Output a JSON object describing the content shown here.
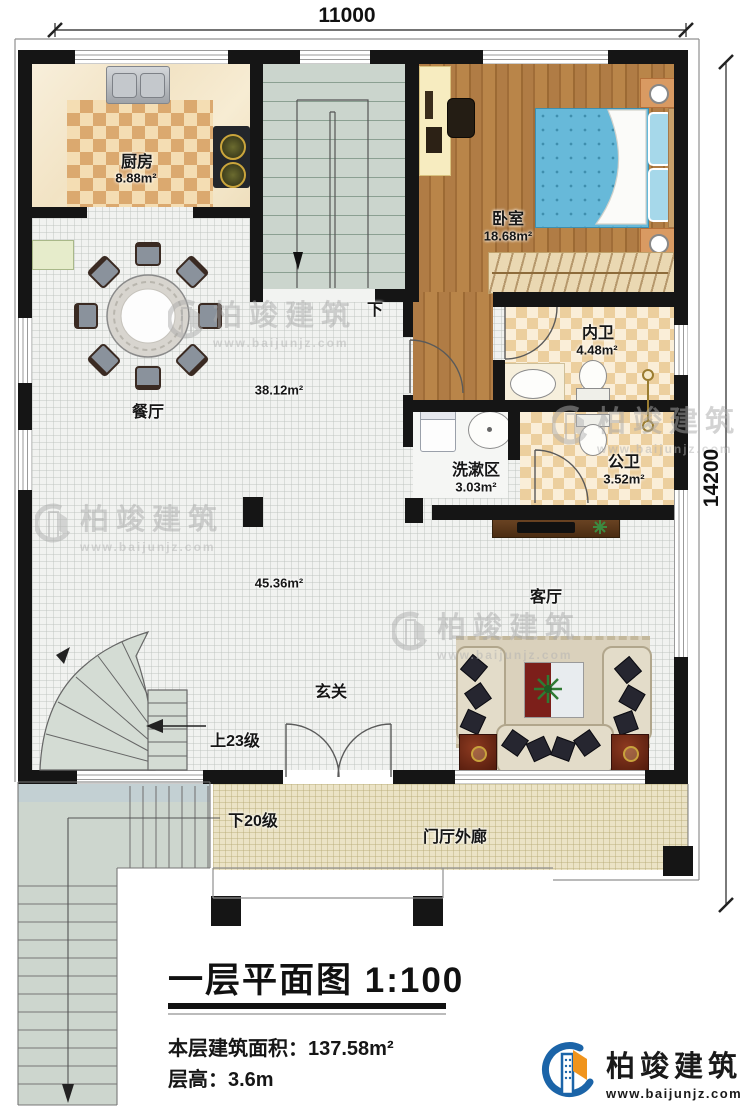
{
  "dimensions": {
    "top": "11000",
    "right": "14200"
  },
  "rooms": {
    "kitchen": {
      "name": "厨房",
      "area": "8.88m²"
    },
    "bedroom": {
      "name": "卧室",
      "area": "18.68m²"
    },
    "inner_bath": {
      "name": "内卫",
      "area": "4.48m²"
    },
    "public_bath": {
      "name": "公卫",
      "area": "3.52m²"
    },
    "wash_area": {
      "name": "洗漱区",
      "area": "3.03m²"
    },
    "dining": {
      "name": "餐厅",
      "area": "38.12m²"
    },
    "living": {
      "name": "客厅",
      "area": "45.36m²"
    },
    "foyer": {
      "name": "玄关"
    },
    "porch": {
      "name": "门厅外廊"
    }
  },
  "stairs": {
    "main_down": "下",
    "up_steps": "上23级",
    "down_steps": "下20级"
  },
  "title_block": {
    "title": "一层平面图",
    "scale": "1:100",
    "area_label": "本层建筑面积：",
    "area_value": "137.58m²",
    "floor_height_label": "层高：",
    "floor_height_value": "3.6m"
  },
  "brand": {
    "name": "柏竣建筑",
    "website": "www.baijunjz.com"
  },
  "watermark": {
    "name": "柏竣建筑",
    "website": "www.baijunjz.com"
  }
}
